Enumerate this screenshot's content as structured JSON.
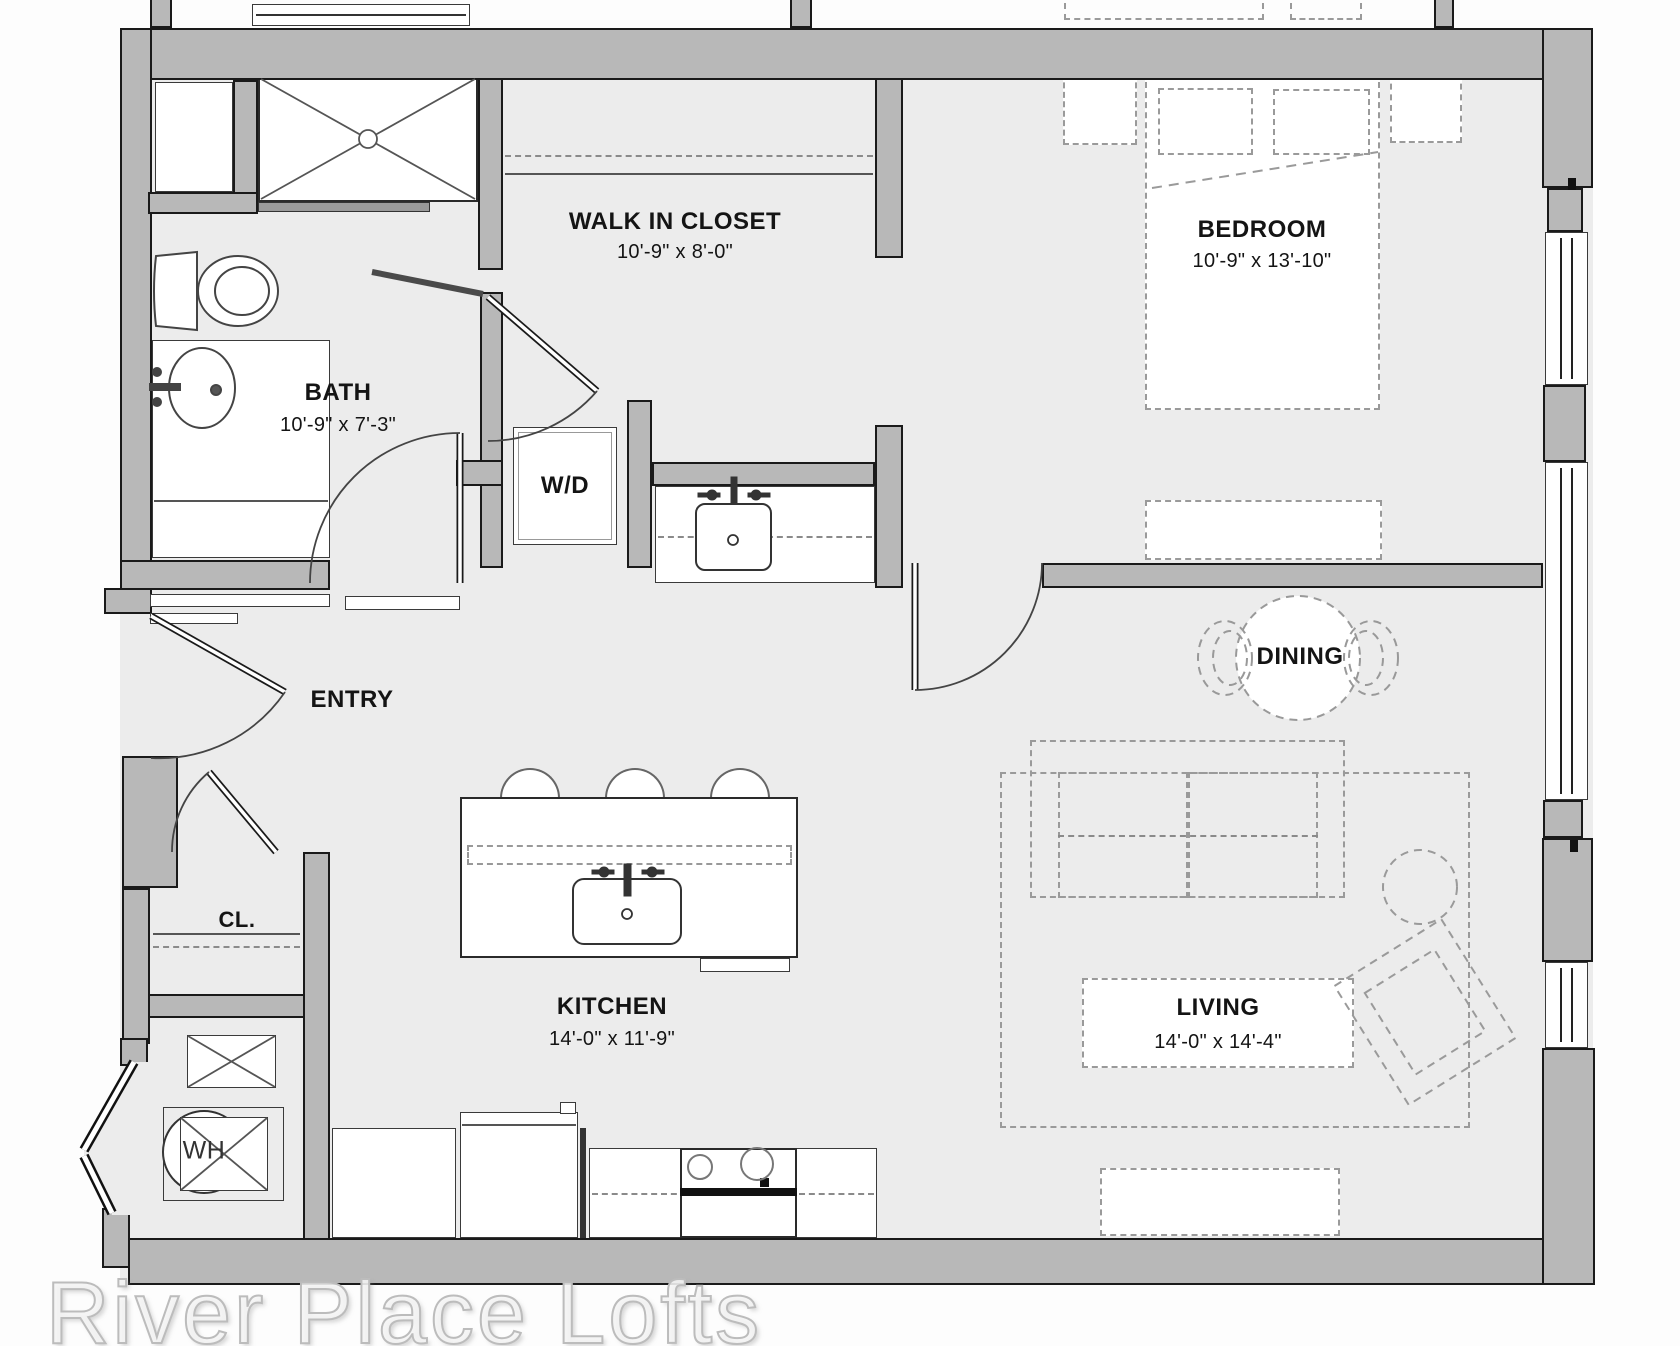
{
  "watermark": "River Place Lofts",
  "rooms": [
    {
      "id": "walk-in-closet",
      "label": "WALK IN CLOSET",
      "dims": "10'-9\" x 8'-0\""
    },
    {
      "id": "bedroom",
      "label": "BEDROOM",
      "dims": "10'-9\" x 13'-10\""
    },
    {
      "id": "bath",
      "label": "BATH",
      "dims": "10'-9\" x 7'-3\""
    },
    {
      "id": "laundry",
      "label": "W/D",
      "dims": ""
    },
    {
      "id": "entry",
      "label": "ENTRY",
      "dims": ""
    },
    {
      "id": "closet",
      "label": "CL.",
      "dims": ""
    },
    {
      "id": "water-heater",
      "label": "WH",
      "dims": ""
    },
    {
      "id": "kitchen",
      "label": "KITCHEN",
      "dims": "14'-0\" x 11'-9\""
    },
    {
      "id": "dining",
      "label": "DINING",
      "dims": ""
    },
    {
      "id": "living",
      "label": "LIVING",
      "dims": "14'-0\" x 14'-4\""
    }
  ],
  "colors": {
    "floor": "#ececec",
    "wall": "#b8b8b8",
    "outline": "#1a1a1a",
    "dashed": "#9a9a9a"
  }
}
